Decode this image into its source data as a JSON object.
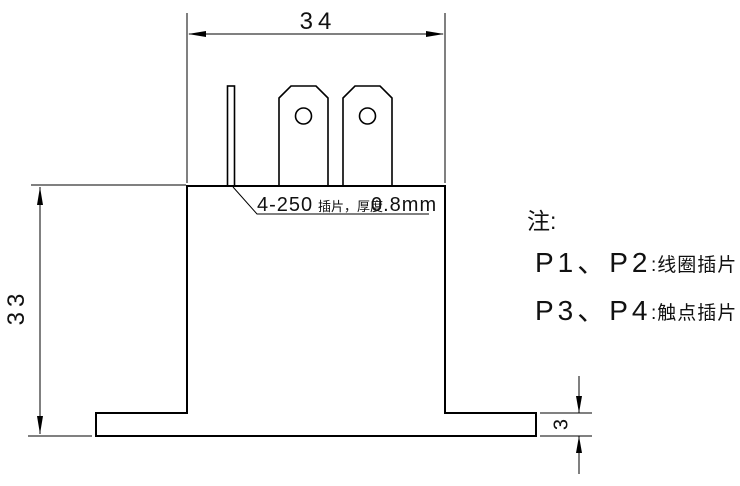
{
  "drawing": {
    "dimensions": {
      "top_width": "34",
      "left_height": "33",
      "flange_thickness": "3"
    },
    "leader_label": {
      "size": "4-250",
      "desc": "插片，厚度",
      "thickness": "0.8mm"
    },
    "notes": {
      "heading": "注:",
      "line1": {
        "pins": "P1、P2",
        "desc": ":线圈插片"
      },
      "line2": {
        "pins": "P3、P4",
        "desc": ":触点插片"
      }
    },
    "colors": {
      "line": "#000000",
      "background": "#ffffff"
    }
  }
}
